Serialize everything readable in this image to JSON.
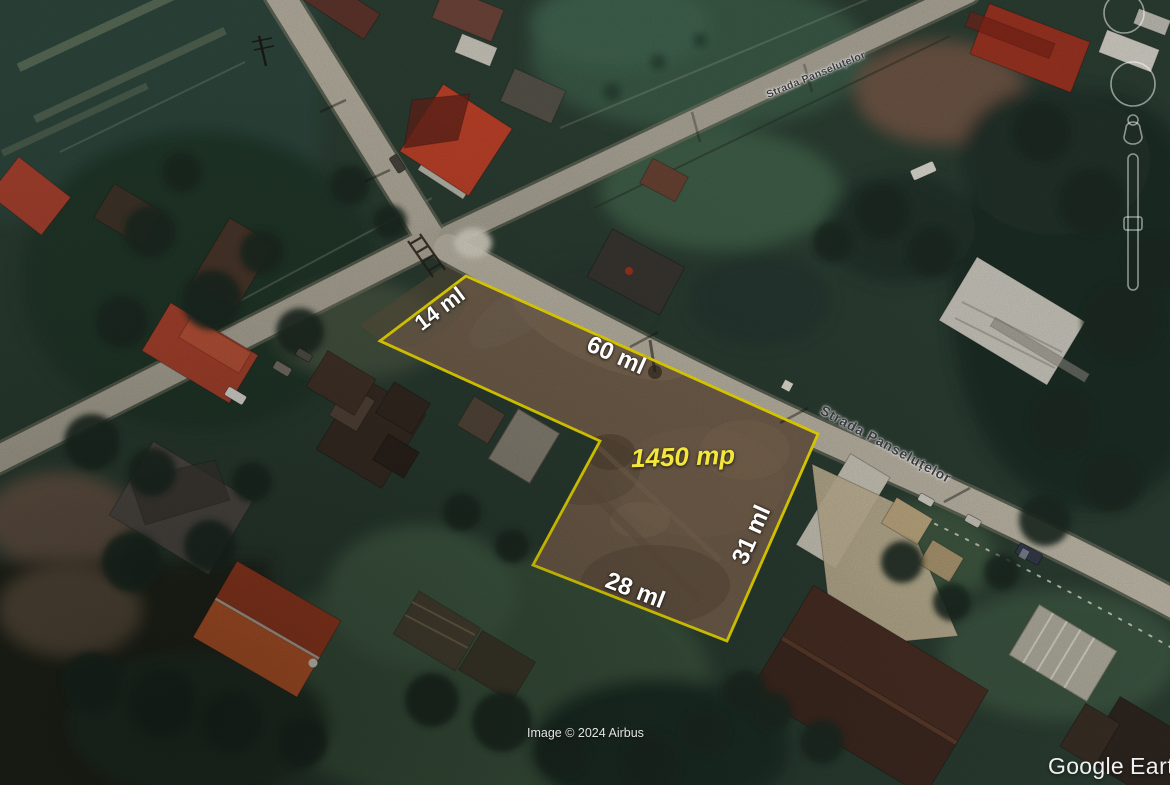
{
  "map": {
    "measurements": {
      "edge_top_left": "14 ml",
      "edge_top": "60 ml",
      "edge_right": "31 ml",
      "edge_bottom": "28 ml",
      "area": "1450 mp"
    },
    "streets": {
      "main": "Strada Panseluțelor",
      "secondary": "Strada Panseluțelor"
    },
    "attribution": "Image © 2024 Airbus",
    "watermark": {
      "primary": "Google",
      "secondary": "Earth"
    },
    "colors": {
      "plot_outline": "#ffec00",
      "area_label": "#f2e73a",
      "measurement_label": "#ffffff",
      "street_label": "#3a3a40",
      "road": "#bdb7a7",
      "plot_dirt": "#77634f"
    },
    "icons": {
      "rotate_control": "rotate-ring-icon",
      "pan_control": "pan-ring-icon",
      "pegman": "pegman-icon",
      "zoom_control": "zoom-slider-icon"
    }
  }
}
